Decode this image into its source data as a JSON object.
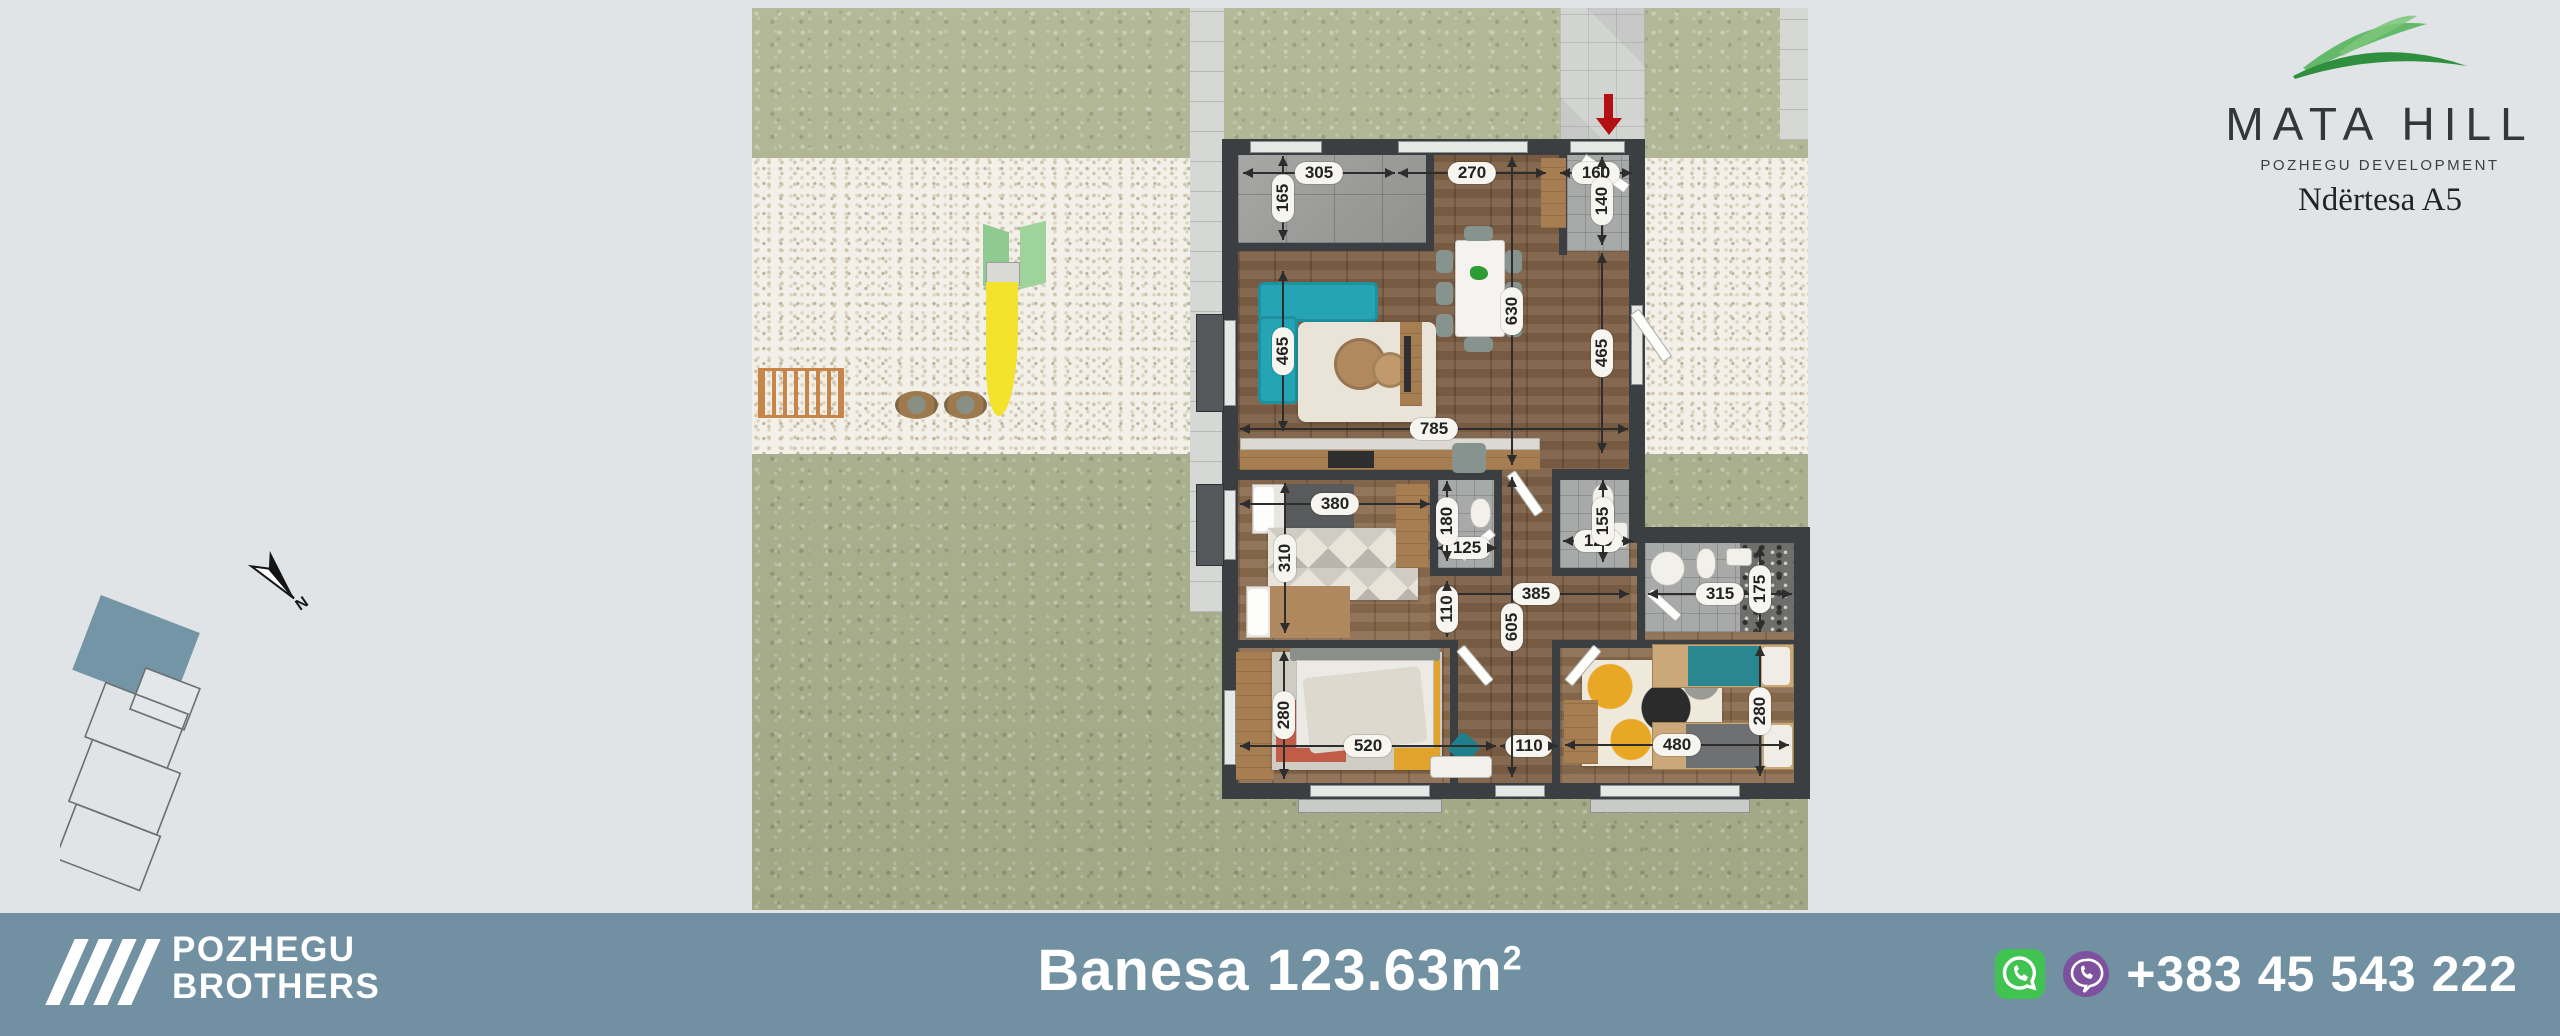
{
  "header": {
    "brand": "MATA HILL",
    "subbrand": "POZHEGU DEVELOPMENT",
    "building": "Ndërtesa A5",
    "leaf_color": "#3f9b47"
  },
  "compass": {
    "label": "N"
  },
  "site_plan": {
    "highlight_color": "#7495a6"
  },
  "floor_plan": {
    "entry_arrow_color": "#b40f12",
    "dims": {
      "d305": "305",
      "d165": "165",
      "d270": "270",
      "d160": "160",
      "d140": "140",
      "d630": "630",
      "d465r": "465",
      "d465l": "465",
      "d785": "785",
      "d380": "380",
      "d310": "310",
      "d180": "180",
      "d125wc": "125",
      "d155": "155",
      "d125b": "125",
      "d385": "385",
      "d110c": "110",
      "d605": "605",
      "d280l": "280",
      "d520": "520",
      "d110d": "110",
      "d315": "315",
      "d175": "175",
      "d480": "480",
      "d280r": "280"
    }
  },
  "footer": {
    "company_line1": "POZHEGU",
    "company_line2": "BROTHERS",
    "area_title": "Banesa 123.63m",
    "area_sup": "2",
    "phone": "+383 45 543 222",
    "bar_color": "#7191a3",
    "whatsapp_color": "#40c351",
    "viber_color": "#7d519d"
  }
}
